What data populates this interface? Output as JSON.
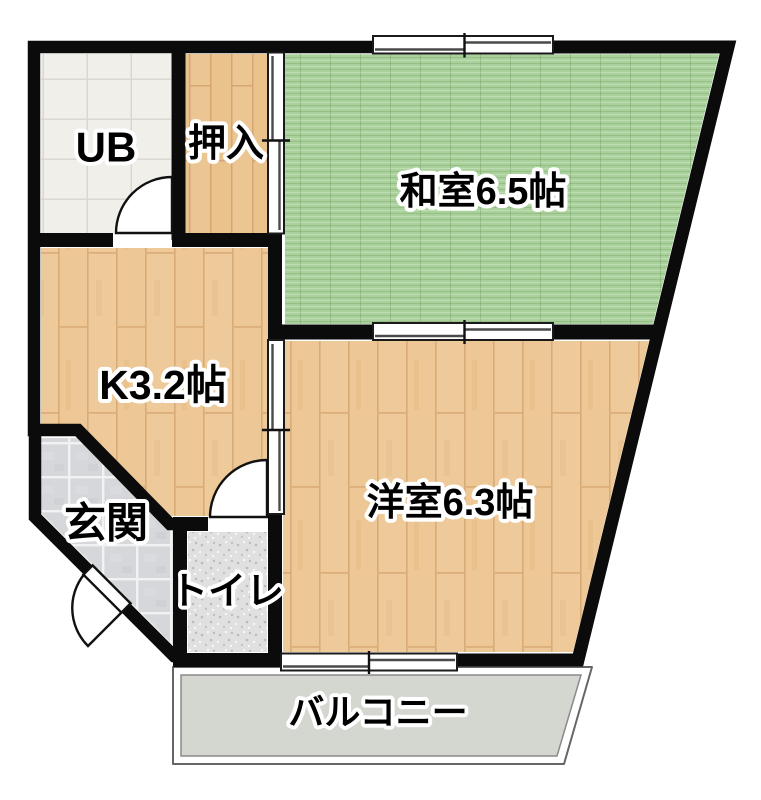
{
  "floorplan": {
    "type": "apartment-floor-plan",
    "rooms": [
      {
        "id": "ub",
        "label": "UB"
      },
      {
        "id": "oshiire",
        "label": "押入"
      },
      {
        "id": "washitsu",
        "label": "和室6.5帖"
      },
      {
        "id": "kitchen",
        "label": "K3.2帖"
      },
      {
        "id": "genkan",
        "label": "玄関"
      },
      {
        "id": "toilet",
        "label": "トイレ"
      },
      {
        "id": "youshitsu",
        "label": "洋室6.3帖"
      },
      {
        "id": "balcony",
        "label": "バルコニー"
      }
    ],
    "colors": {
      "wall": "#0b0b0b",
      "tatami_green": "#aad19c",
      "wood_floor": "#edc795",
      "ub_tile": "#f1efe9",
      "genkan_tile": "#d6d7da",
      "toilet_floor": "#e0e0e0",
      "balcony_slab": "#d4d6d0",
      "background": "#ffffff"
    }
  }
}
